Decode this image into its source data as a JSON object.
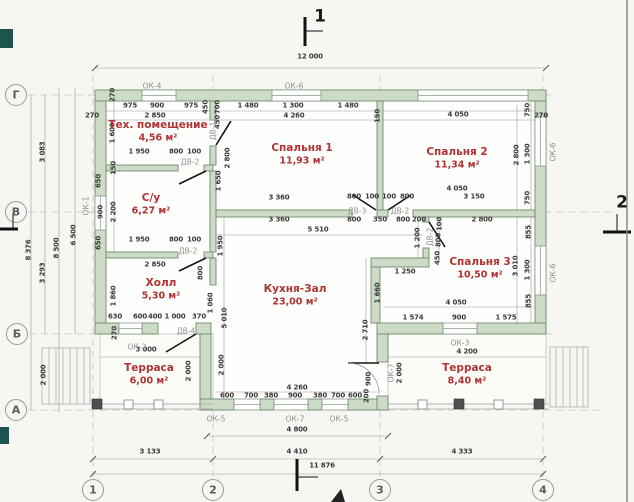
{
  "meta": {
    "width": 634,
    "height": 502,
    "drawing_kind": "floor plan"
  },
  "palette": {
    "paper": "#f6f6f3",
    "wall_fill": "#cddcc6",
    "wall_stroke": "#6f8d6c",
    "room_label": "#b03231",
    "dim_text": "#3b3b3b",
    "tag_text": "#8f8f8f",
    "grid": "#c6c6c4",
    "accent_dark": "#1d5450"
  },
  "rooms": [
    {
      "name": "Тех. помещение",
      "area": "4,56 м²",
      "x": 158,
      "y": 125
    },
    {
      "name": "С/у",
      "area": "6,27 м²",
      "x": 151,
      "y": 198
    },
    {
      "name": "Спальня 1",
      "area": "11,93 м²",
      "x": 302,
      "y": 148
    },
    {
      "name": "Спальня 2",
      "area": "11,34 м²",
      "x": 457,
      "y": 152
    },
    {
      "name": "Спальня 3",
      "area": "10,50 м²",
      "x": 480,
      "y": 262
    },
    {
      "name": "Холл",
      "area": "5,30 м²",
      "x": 161,
      "y": 283
    },
    {
      "name": "Кухня-Зал",
      "area": "23,00 м²",
      "x": 295,
      "y": 289
    },
    {
      "name": "Терраса",
      "area": "6,00 м²",
      "x": 149,
      "y": 368
    },
    {
      "name": "Терраса",
      "area": "8,40 м²",
      "x": 467,
      "y": 368
    }
  ],
  "tags": [
    {
      "t": "ОК-4",
      "x": 152,
      "y": 86
    },
    {
      "t": "ОК-6",
      "x": 294,
      "y": 86
    },
    {
      "t": "ОК-1",
      "x": 86,
      "y": 206,
      "r": 1
    },
    {
      "t": "ОК-2",
      "x": 137,
      "y": 347
    },
    {
      "t": "ОК-3",
      "x": 460,
      "y": 343
    },
    {
      "t": "ОК-5",
      "x": 216,
      "y": 419
    },
    {
      "t": "ОК-7",
      "x": 295,
      "y": 419
    },
    {
      "t": "ОК-5",
      "x": 339,
      "y": 419
    },
    {
      "t": "ОК-7",
      "x": 391,
      "y": 373,
      "r": 1
    },
    {
      "t": "ОК-6",
      "x": 553,
      "y": 152,
      "r": 1
    },
    {
      "t": "ОК-6",
      "x": 553,
      "y": 273,
      "r": 1
    },
    {
      "t": "ДВ-1",
      "x": 213,
      "y": 131,
      "r": 1
    },
    {
      "t": "ДВ-2",
      "x": 190,
      "y": 162
    },
    {
      "t": "ДВ-2",
      "x": 188,
      "y": 251
    },
    {
      "t": "ДВ-3",
      "x": 357,
      "y": 211
    },
    {
      "t": "ДВ-2",
      "x": 400,
      "y": 211
    },
    {
      "t": "ДВ-2",
      "x": 430,
      "y": 237,
      "r": 1
    },
    {
      "t": "ДВ-4",
      "x": 186,
      "y": 331
    }
  ],
  "axis_markers": [
    {
      "t": "Г",
      "x": 16,
      "y": 95
    },
    {
      "t": "В",
      "x": 16,
      "y": 212
    },
    {
      "t": "Б",
      "x": 17,
      "y": 334
    },
    {
      "t": "А",
      "x": 16,
      "y": 410
    },
    {
      "t": "1",
      "x": 93,
      "y": 490
    },
    {
      "t": "2",
      "x": 213,
      "y": 490
    },
    {
      "t": "3",
      "x": 380,
      "y": 490
    },
    {
      "t": "4",
      "x": 543,
      "y": 490
    }
  ],
  "section_markers": [
    {
      "t": "1",
      "x": 320,
      "y": 17
    },
    {
      "t": "2",
      "x": 622,
      "y": 203
    }
  ],
  "dims": [
    {
      "t": "12 000",
      "x": 310,
      "y": 57
    },
    {
      "t": "975",
      "x": 130,
      "y": 106
    },
    {
      "t": "900",
      "x": 157,
      "y": 106
    },
    {
      "t": "975",
      "x": 191,
      "y": 106
    },
    {
      "t": "450",
      "x": 206,
      "y": 107,
      "r": 1
    },
    {
      "t": "700",
      "x": 218,
      "y": 107,
      "r": 1
    },
    {
      "t": "450",
      "x": 218,
      "y": 122,
      "r": 1
    },
    {
      "t": "1 480",
      "x": 248,
      "y": 106
    },
    {
      "t": "1 300",
      "x": 293,
      "y": 106
    },
    {
      "t": "1 480",
      "x": 348,
      "y": 106
    },
    {
      "t": "270",
      "x": 92,
      "y": 116
    },
    {
      "t": "270",
      "x": 113,
      "y": 95,
      "r": 1
    },
    {
      "t": "2 850",
      "x": 155,
      "y": 116
    },
    {
      "t": "4 260",
      "x": 294,
      "y": 116
    },
    {
      "t": "150",
      "x": 378,
      "y": 116,
      "r": 1
    },
    {
      "t": "4 050",
      "x": 458,
      "y": 115
    },
    {
      "t": "750",
      "x": 528,
      "y": 110,
      "r": 1
    },
    {
      "t": "270",
      "x": 541,
      "y": 116
    },
    {
      "t": "1 300",
      "x": 528,
      "y": 154,
      "r": 1
    },
    {
      "t": "2 800",
      "x": 517,
      "y": 155,
      "r": 1
    },
    {
      "t": "750",
      "x": 528,
      "y": 198,
      "r": 1
    },
    {
      "t": "3 083",
      "x": 43,
      "y": 152,
      "r": 1
    },
    {
      "t": "3 293",
      "x": 43,
      "y": 273,
      "r": 1
    },
    {
      "t": "8 376",
      "x": 29,
      "y": 250,
      "r": 1
    },
    {
      "t": "8 500",
      "x": 57,
      "y": 248,
      "r": 1
    },
    {
      "t": "6 500",
      "x": 74,
      "y": 235,
      "r": 1
    },
    {
      "t": "2 000",
      "x": 44,
      "y": 375,
      "r": 1
    },
    {
      "t": "650",
      "x": 99,
      "y": 181,
      "r": 1
    },
    {
      "t": "900",
      "x": 101,
      "y": 212,
      "r": 1
    },
    {
      "t": "650",
      "x": 99,
      "y": 243,
      "r": 1
    },
    {
      "t": "2 200",
      "x": 114,
      "y": 212,
      "r": 1
    },
    {
      "t": "1 600",
      "x": 113,
      "y": 133,
      "r": 1
    },
    {
      "t": "150",
      "x": 114,
      "y": 168,
      "r": 1
    },
    {
      "t": "1 860",
      "x": 114,
      "y": 296,
      "r": 1
    },
    {
      "t": "1 950",
      "x": 139,
      "y": 152
    },
    {
      "t": "800",
      "x": 176,
      "y": 152
    },
    {
      "t": "100",
      "x": 194,
      "y": 152
    },
    {
      "t": "1 950",
      "x": 139,
      "y": 240
    },
    {
      "t": "800",
      "x": 176,
      "y": 240
    },
    {
      "t": "100",
      "x": 194,
      "y": 240
    },
    {
      "t": "2 850",
      "x": 155,
      "y": 265
    },
    {
      "t": "1 650",
      "x": 219,
      "y": 181,
      "r": 1
    },
    {
      "t": "2 800",
      "x": 228,
      "y": 158,
      "r": 1
    },
    {
      "t": "3 360",
      "x": 279,
      "y": 198
    },
    {
      "t": "800",
      "x": 354,
      "y": 197
    },
    {
      "t": "100",
      "x": 372,
      "y": 197
    },
    {
      "t": "100",
      "x": 389,
      "y": 197
    },
    {
      "t": "800",
      "x": 407,
      "y": 197
    },
    {
      "t": "3 150",
      "x": 474,
      "y": 197
    },
    {
      "t": "4 050",
      "x": 457,
      "y": 189
    },
    {
      "t": "3 360",
      "x": 279,
      "y": 220
    },
    {
      "t": "800",
      "x": 354,
      "y": 220
    },
    {
      "t": "350",
      "x": 380,
      "y": 220
    },
    {
      "t": "800",
      "x": 403,
      "y": 220
    },
    {
      "t": "200",
      "x": 419,
      "y": 220
    },
    {
      "t": "2 800",
      "x": 482,
      "y": 220
    },
    {
      "t": "5 510",
      "x": 318,
      "y": 230
    },
    {
      "t": "100",
      "x": 440,
      "y": 224,
      "r": 1
    },
    {
      "t": "800",
      "x": 439,
      "y": 240,
      "r": 1
    },
    {
      "t": "450",
      "x": 438,
      "y": 258,
      "r": 1
    },
    {
      "t": "1 200",
      "x": 418,
      "y": 238,
      "r": 1
    },
    {
      "t": "1 250",
      "x": 405,
      "y": 272
    },
    {
      "t": "1 660",
      "x": 378,
      "y": 293,
      "r": 1
    },
    {
      "t": "2 710",
      "x": 366,
      "y": 330,
      "r": 1
    },
    {
      "t": "855",
      "x": 529,
      "y": 232,
      "r": 1
    },
    {
      "t": "3 010",
      "x": 516,
      "y": 266,
      "r": 1
    },
    {
      "t": "1 300",
      "x": 528,
      "y": 270,
      "r": 1
    },
    {
      "t": "855",
      "x": 529,
      "y": 301,
      "r": 1
    },
    {
      "t": "4 050",
      "x": 456,
      "y": 303
    },
    {
      "t": "1 574",
      "x": 413,
      "y": 318
    },
    {
      "t": "900",
      "x": 459,
      "y": 318
    },
    {
      "t": "1 575",
      "x": 506,
      "y": 318
    },
    {
      "t": "630",
      "x": 115,
      "y": 317
    },
    {
      "t": "600",
      "x": 140,
      "y": 317
    },
    {
      "t": "400",
      "x": 155,
      "y": 317
    },
    {
      "t": "1 000",
      "x": 175,
      "y": 317
    },
    {
      "t": "370",
      "x": 199,
      "y": 317
    },
    {
      "t": "1 060",
      "x": 211,
      "y": 303,
      "r": 1
    },
    {
      "t": "1 950",
      "x": 221,
      "y": 246,
      "r": 1
    },
    {
      "t": "800",
      "x": 201,
      "y": 273,
      "r": 1
    },
    {
      "t": "5 010",
      "x": 225,
      "y": 318,
      "r": 1
    },
    {
      "t": "270",
      "x": 115,
      "y": 333,
      "r": 1
    },
    {
      "t": "2 000",
      "x": 189,
      "y": 371,
      "r": 1
    },
    {
      "t": "2 000",
      "x": 222,
      "y": 365,
      "r": 1
    },
    {
      "t": "900",
      "x": 369,
      "y": 379,
      "r": 1
    },
    {
      "t": "200",
      "x": 367,
      "y": 396,
      "r": 1
    },
    {
      "t": "2 000",
      "x": 400,
      "y": 373,
      "r": 1
    },
    {
      "t": "3 000",
      "x": 146,
      "y": 350
    },
    {
      "t": "4 200",
      "x": 467,
      "y": 352
    },
    {
      "t": "4 260",
      "x": 297,
      "y": 388
    },
    {
      "t": "600",
      "x": 227,
      "y": 396
    },
    {
      "t": "700",
      "x": 251,
      "y": 396
    },
    {
      "t": "380",
      "x": 271,
      "y": 396
    },
    {
      "t": "900",
      "x": 295,
      "y": 396
    },
    {
      "t": "380",
      "x": 320,
      "y": 396
    },
    {
      "t": "700",
      "x": 338,
      "y": 396
    },
    {
      "t": "600",
      "x": 355,
      "y": 396
    },
    {
      "t": "4 800",
      "x": 297,
      "y": 430
    },
    {
      "t": "3 133",
      "x": 150,
      "y": 452
    },
    {
      "t": "4 410",
      "x": 297,
      "y": 452
    },
    {
      "t": "4 333",
      "x": 462,
      "y": 452
    },
    {
      "t": "11 876",
      "x": 322,
      "y": 466
    }
  ]
}
